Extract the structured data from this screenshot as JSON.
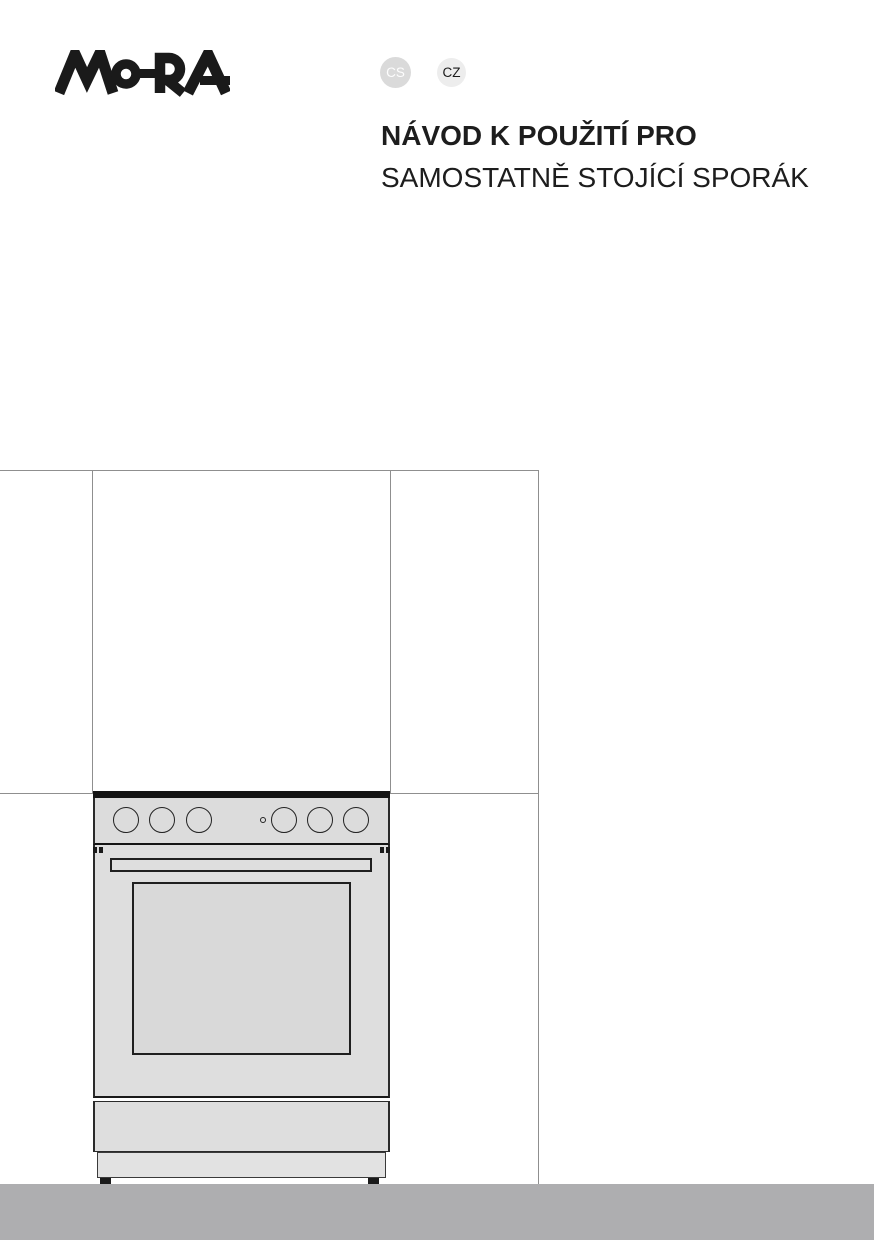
{
  "page": {
    "width": 874,
    "height": 1240,
    "background": "#ffffff"
  },
  "header": {
    "logo_text": "MORA",
    "languages": [
      {
        "label": "CS",
        "circle_color": "#dadada",
        "text_color": "#fdfdfd"
      },
      {
        "label": "CZ",
        "circle_color": "#ededed",
        "text_color": "#1a1a1a"
      }
    ],
    "title_line1": "NÁVOD K POUŽITÍ PRO",
    "title_line2": "SAMOSTATNĚ STOJÍCÍ SPORÁK"
  },
  "illustration": {
    "name": "freestanding-cooker-in-kitchen-niche",
    "guide_line_color": "#8f8f8f",
    "cooker_outline_color": "#1f1f1f",
    "cooker_fill_color": "#dedede",
    "knobs_left": 3,
    "knobs_right": 3
  },
  "footer": {
    "bar_color": "#aeaeb0"
  }
}
